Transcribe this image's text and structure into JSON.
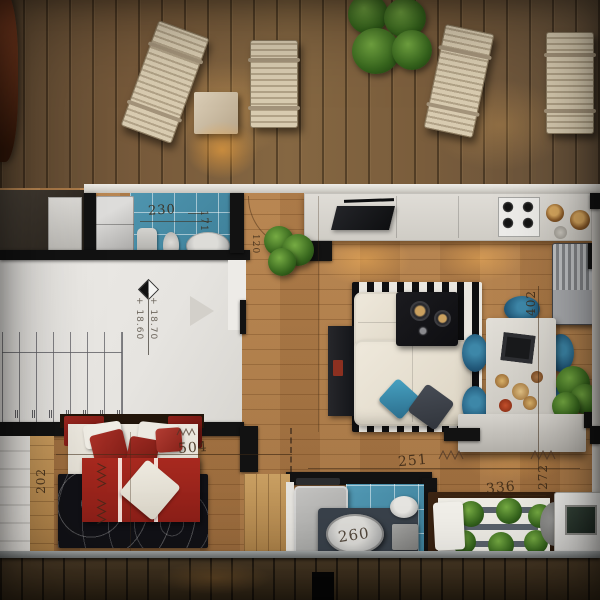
{
  "annotations": {
    "bath_top_width": "230",
    "bath_top_depth": "171",
    "hall_width_small": "120",
    "elevation_upper": "+ 18.70",
    "elevation_lower": "+ 18.60",
    "bedroom_width": "504",
    "bedroom_depth": "202",
    "living_width": "251",
    "dining_depth": "402",
    "guestbed_width": "336",
    "guestbed_depth": "272",
    "tub_width": "260"
  },
  "palette": {
    "tile_blue": "#4e92ac",
    "interior_wood": "#ab7c4b",
    "deck_wood": "#73593a",
    "accent_red": "#9c2a22",
    "chair_teal": "#2d6e8e",
    "plant_green": "#4c7d33",
    "rug_black": "#121215",
    "counter_white": "#d9d6d0"
  }
}
